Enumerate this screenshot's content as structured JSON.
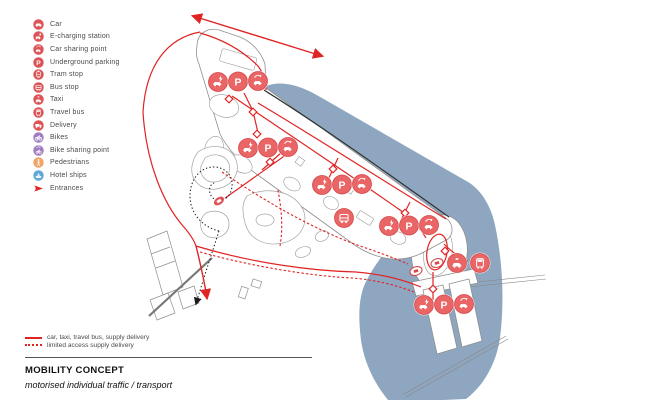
{
  "legend": {
    "items": [
      {
        "label": "Car",
        "icon": "car",
        "color": "#dd5457"
      },
      {
        "label": "E-charging station",
        "icon": "e-charging",
        "color": "#dd5457"
      },
      {
        "label": "Car sharing point",
        "icon": "car-sharing",
        "color": "#dd5457"
      },
      {
        "label": "Underground parking",
        "icon": "parking",
        "color": "#dd5457"
      },
      {
        "label": "Tram stop",
        "icon": "tram",
        "color": "#dd5457"
      },
      {
        "label": "Bus stop",
        "icon": "bus",
        "color": "#dd5457"
      },
      {
        "label": "Taxi",
        "icon": "taxi",
        "color": "#dd5457"
      },
      {
        "label": "Travel bus",
        "icon": "travel-bus",
        "color": "#dd5457"
      },
      {
        "label": "Delivery",
        "icon": "delivery",
        "color": "#dd5457"
      },
      {
        "label": "Bikes",
        "icon": "bike",
        "color": "#a07cc0"
      },
      {
        "label": "Bike sharing point",
        "icon": "bike-sharing",
        "color": "#a07cc0"
      },
      {
        "label": "Pedestrians",
        "icon": "pedestrian",
        "color": "#f0a566"
      },
      {
        "label": "Hotel ships",
        "icon": "ship",
        "color": "#5fa8d8"
      },
      {
        "label": "Entrances",
        "icon": "entrance-arrow",
        "color": "#e02424"
      }
    ]
  },
  "line_legend": {
    "solid_label": "car, taxi, travel bus, supply delivery",
    "dotted_label": "limited access supply delivery"
  },
  "footer": {
    "title": "MOBILITY CONCEPT",
    "subtitle": "motorised individual traffic / transport"
  },
  "map": {
    "colors": {
      "water": "#8ea6c0",
      "road": "#e02424",
      "marker_fill": "#ea6565",
      "marker_ring": "#d4494c",
      "outline": "#8f8f8f"
    },
    "clusters": [
      {
        "x": 218,
        "y": 82,
        "icons": [
          "e-charging",
          "parking",
          "car-sharing"
        ]
      },
      {
        "x": 248,
        "y": 148,
        "icons": [
          "e-charging",
          "parking",
          "car-sharing"
        ]
      },
      {
        "x": 322,
        "y": 185,
        "icons": [
          "e-charging",
          "parking",
          "car-sharing"
        ]
      },
      {
        "x": 389,
        "y": 226,
        "icons": [
          "e-charging",
          "parking",
          "car-sharing"
        ]
      },
      {
        "x": 424,
        "y": 305,
        "icons": [
          "e-charging",
          "parking",
          "car-sharing"
        ]
      },
      {
        "x": 344,
        "y": 218,
        "icons": [
          "bus"
        ]
      },
      {
        "x": 457,
        "y": 263,
        "icons": [
          "taxi"
        ]
      },
      {
        "x": 480,
        "y": 263,
        "icons": [
          "travel-bus"
        ]
      }
    ],
    "stops": [
      {
        "x": 219,
        "y": 201,
        "style": "filled",
        "rot": -35
      },
      {
        "x": 416,
        "y": 271,
        "style": "outline",
        "rot": -18
      },
      {
        "x": 437,
        "y": 263,
        "style": "outline",
        "rot": -18
      }
    ],
    "entrance_markers": [
      [
        229,
        99
      ],
      [
        253,
        112
      ],
      [
        257,
        134
      ],
      [
        270,
        162
      ],
      [
        333,
        169
      ],
      [
        405,
        213
      ],
      [
        445,
        251
      ],
      [
        433,
        289
      ]
    ]
  }
}
